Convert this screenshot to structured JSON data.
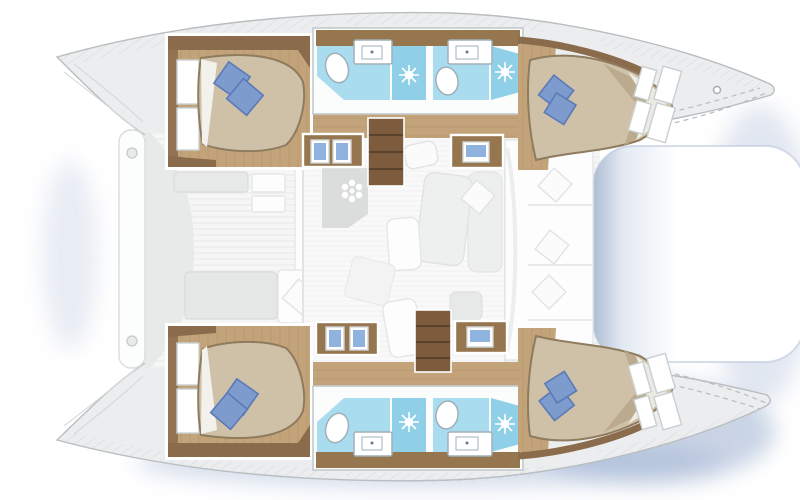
{
  "meta": {
    "title": "Catamaran yacht floor plan – top view, 4-cabin / 4-head layout",
    "domain": "boat layout diagram",
    "orientation": "bows pointing right, transoms left",
    "visible_text": "none"
  },
  "palette": {
    "hull": "#ecedee",
    "hullStroke": "#b8bdc0",
    "deck": "#f5f6f5",
    "deckLine": "#e7eae9",
    "salonFloor": "#f8f9f8",
    "salonLine": "#eff1f0",
    "wall": "#8a6b4c",
    "wood": "#c3a47a",
    "woodGrain": "#a8885e",
    "woodDark": "#96764f",
    "stair": "#7c5c3d",
    "stairGap": "#4e3a26",
    "bed": "#cfc1a8",
    "bedEdge": "#8f7b5e",
    "bedShade": "#b7a689",
    "sheet": "#f2f1ec",
    "pillow": "#7e9bcd",
    "pillowDark": "#5a7ab8",
    "bath": "#aadcef",
    "shower": "#8fd0e8",
    "fixture": "#ffffff",
    "fixtureStroke": "#9fb0b8",
    "counterGray": "#dadddc",
    "sofa": "#eef0ef",
    "sofaStroke": "#e0e3e2",
    "laptop": "#8fb2de",
    "shadow": "#94a9cc",
    "tramp": "#b3c1d6",
    "dash": "#b9bfc2",
    "hatch": "#ccd1d3"
  },
  "vessel": {
    "type": "catamaran",
    "view": "top-down interior floor plan",
    "hulls": [
      "port (top)",
      "starboard (bottom)"
    ],
    "cabins": [
      {
        "id": "port-aft",
        "position": "top-left",
        "bed": "double",
        "pillows": 2,
        "headboard": "forward-facing slats"
      },
      {
        "id": "port-forward",
        "position": "top-right",
        "bed": "double tapered to bow",
        "pillows": 2
      },
      {
        "id": "starboard-aft",
        "position": "bottom-left",
        "bed": "double",
        "pillows": 2,
        "headboard": "forward-facing slats"
      },
      {
        "id": "starboard-forward",
        "position": "bottom-right",
        "bed": "double tapered to bow",
        "pillows": 2
      }
    ],
    "bathrooms": [
      {
        "id": "port-aft-head",
        "fixtures": [
          "sink",
          "toilet",
          "separate shower"
        ]
      },
      {
        "id": "port-forward-head",
        "fixtures": [
          "sink",
          "toilet",
          "separate shower"
        ]
      },
      {
        "id": "starboard-aft-head",
        "fixtures": [
          "sink",
          "toilet",
          "separate shower"
        ]
      },
      {
        "id": "starboard-forward-head",
        "fixtures": [
          "sink",
          "toilet",
          "separate shower"
        ]
      }
    ],
    "salon": {
      "features": [
        "galley counter with double sink",
        "stove",
        "nav desk with laptop",
        "lounge seating",
        "throw pillows",
        "companionway stairs to each hull"
      ]
    },
    "cockpit": {
      "position": "aft (left)",
      "features": [
        "bench seats",
        "table / sunpad",
        "cushion"
      ]
    },
    "exterior": [
      "trampoline between bows",
      "foredeck with dashed deck lines",
      "anchor windlass fitting",
      "aft platform beam with davit fittings",
      "transom steps",
      "non-skid hatched side decks"
    ]
  }
}
